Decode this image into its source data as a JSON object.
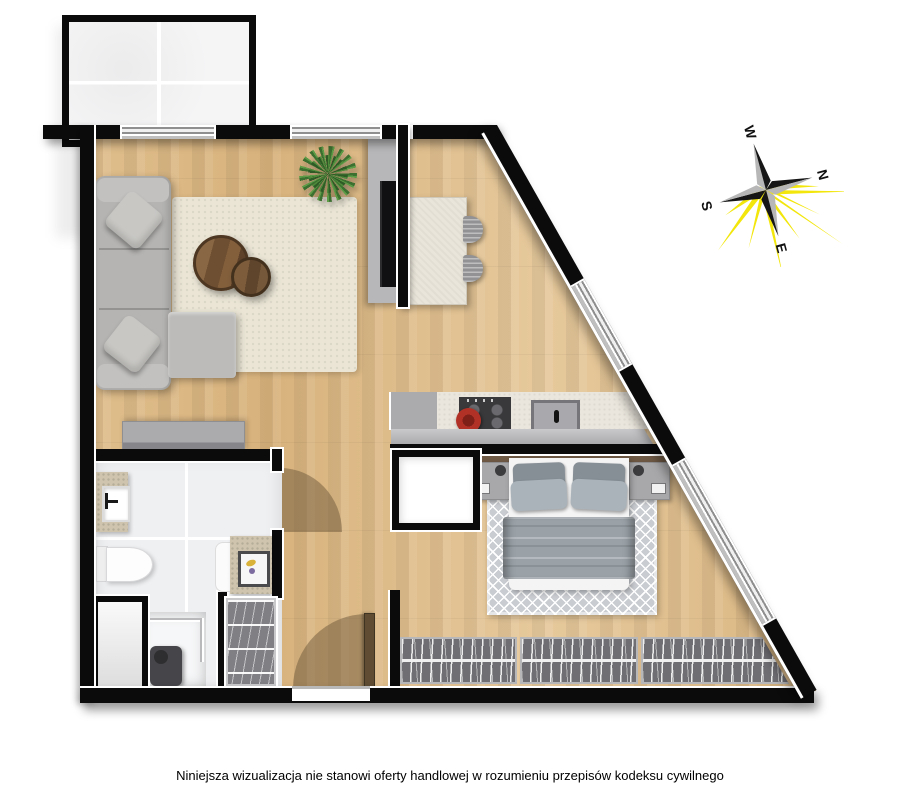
{
  "canvas": {
    "width_px": 900,
    "height_px": 795,
    "background": "#ffffff"
  },
  "disclaimer": {
    "text": "Niniejsza wizualizacja nie stanowi oferty handlowej w rozumieniu przepisów kodeksu cywilnego"
  },
  "compass": {
    "labels": {
      "north": "N",
      "east": "E",
      "south": "S",
      "west": "W"
    },
    "rotation_deg": 75,
    "colors": {
      "rays": "#f2e60a",
      "dark_half": "#161616",
      "light_half": "#b7b7b7",
      "label": "#111111"
    }
  },
  "floorplan": {
    "type": "apartment-top-view",
    "rooms": [
      "balcony",
      "living-room-with-kitchenette",
      "hallway",
      "bathroom",
      "bedroom"
    ],
    "furniture": [
      "corner-sofa",
      "sofa-pillows",
      "living-rug",
      "coffee-tables",
      "potted-plant",
      "tv-on-partition-wall",
      "sideboard",
      "dining-table",
      "dining-chairs",
      "kitchen-cabinet",
      "kitchen-counter",
      "cooktop-with-pot",
      "kitchen-sink",
      "double-bed",
      "nightstands-with-lamps",
      "bedroom-rug",
      "wardrobe-with-hangers",
      "bathroom-closet",
      "washbasin",
      "toilet",
      "vanity-with-basin",
      "shower",
      "technical-shaft",
      "entrance-door",
      "bathroom-door"
    ],
    "colors": {
      "wall": "#0b0b0b",
      "wood_floor": "#ddbb89",
      "tile_floor": "#eff0f2",
      "window_frame": "#8f8f8f",
      "sofa": "#b5b4b2",
      "living_rug": "#eae5d5",
      "coffee_table": "#6f4f31",
      "plant": "#4e8a3a",
      "bed_blanket": "#9aa2a8",
      "bedroom_rug": "#c9ccd1",
      "wardrobe": "#6e6e73",
      "counter": "#eae6dd",
      "cooktop": "#39393b",
      "pot": "#b23127",
      "door_swing": "rgba(90,72,45,0.42)"
    }
  }
}
